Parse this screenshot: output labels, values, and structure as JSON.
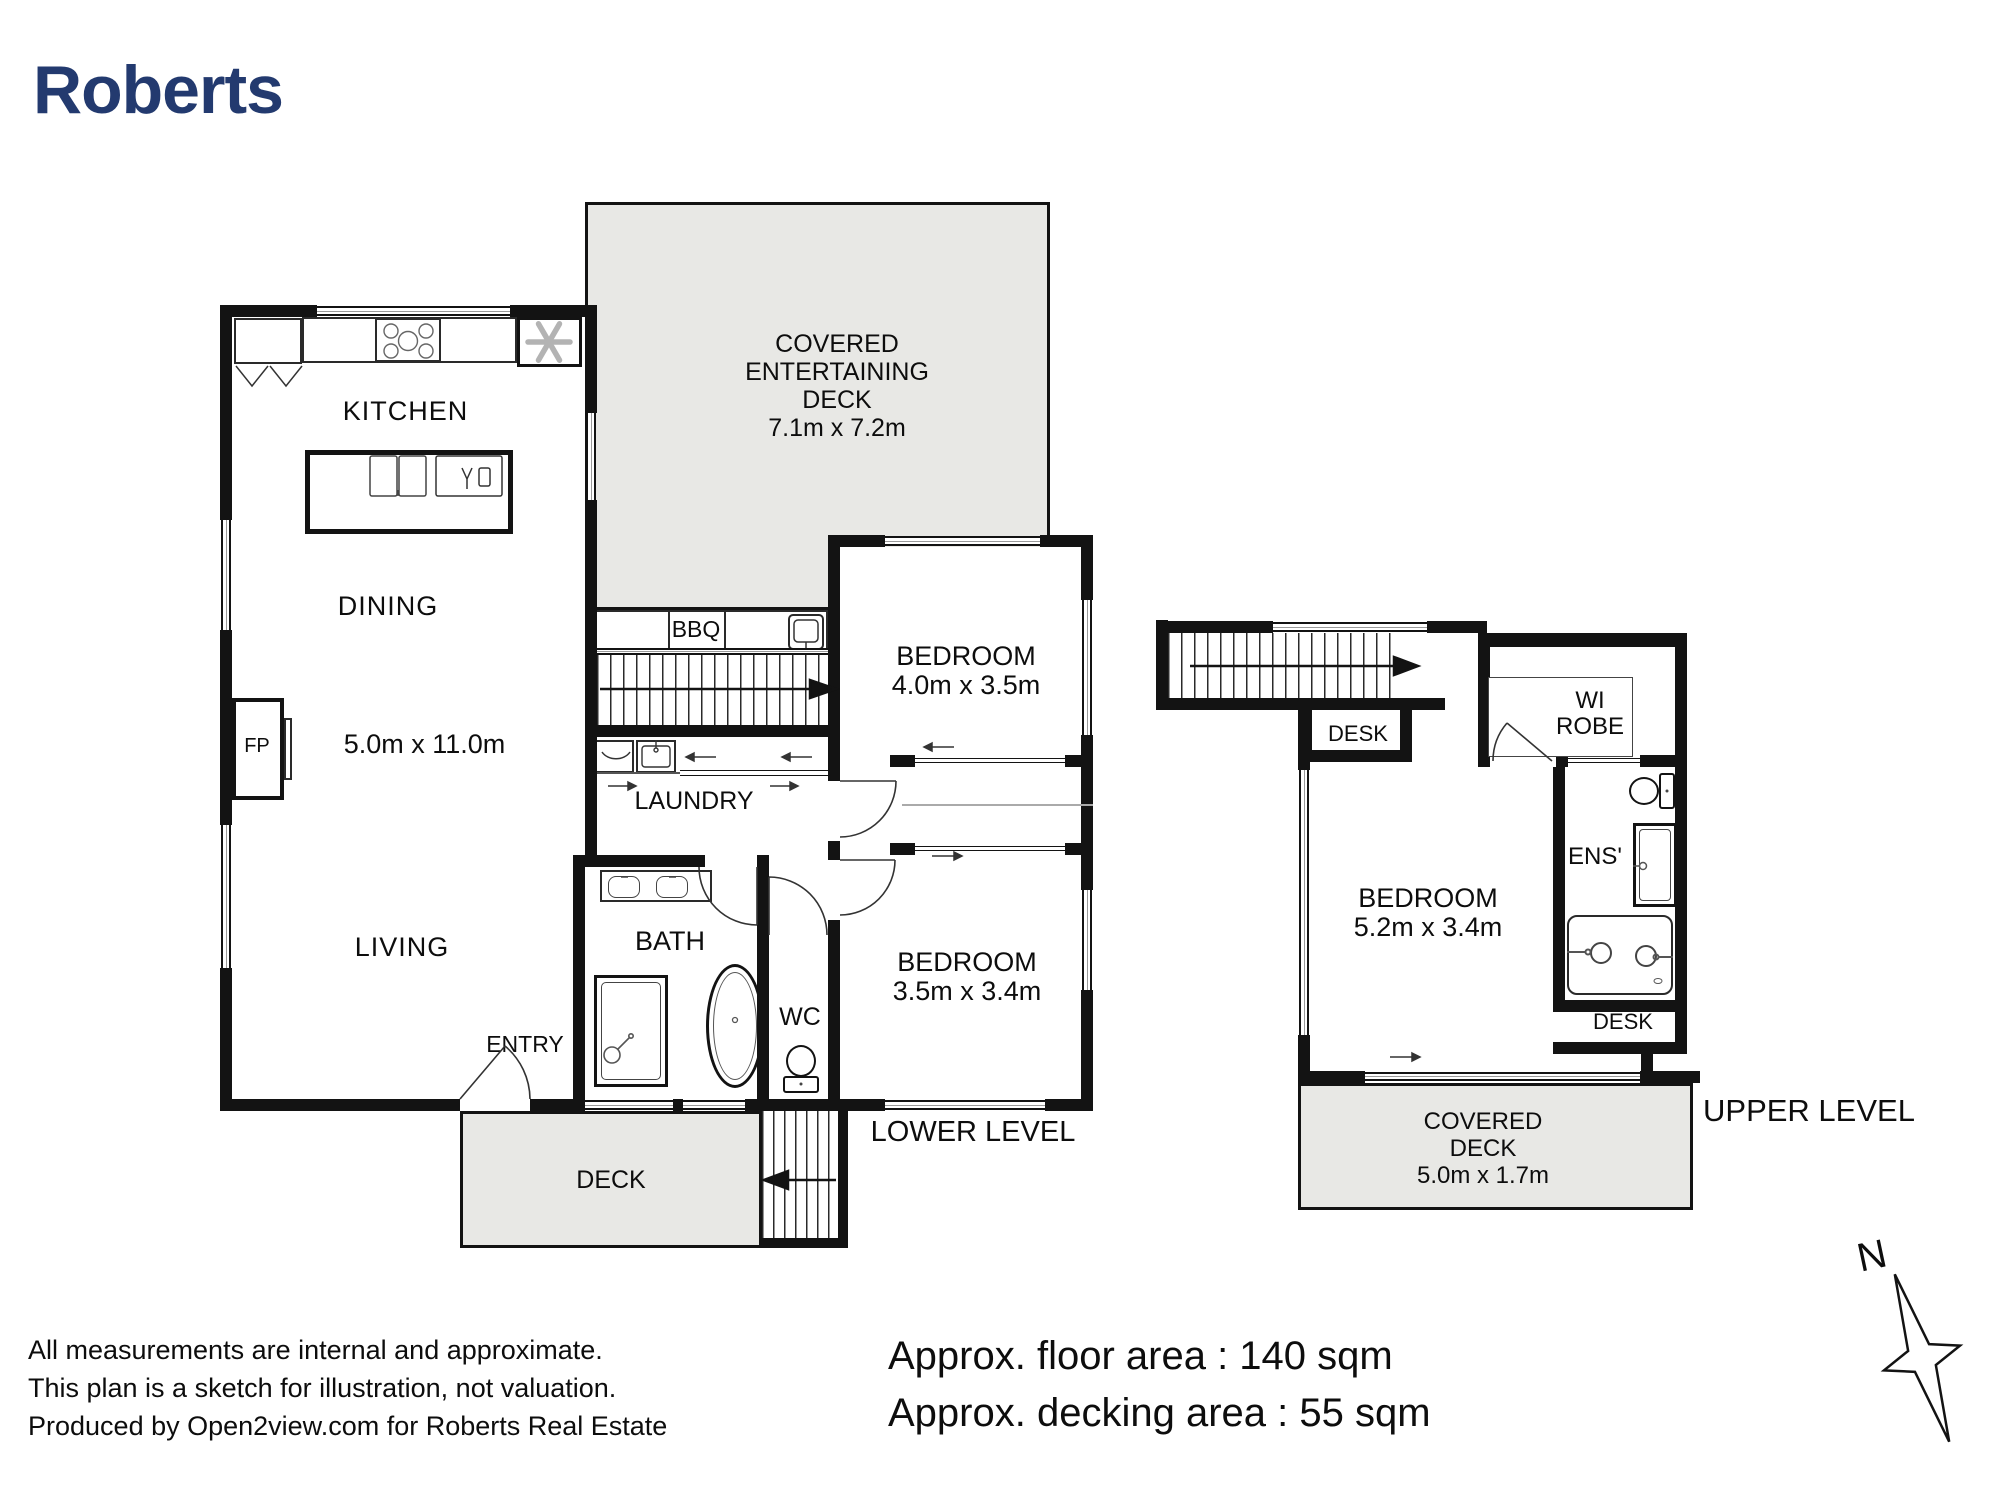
{
  "brand": {
    "logo": "Roberts",
    "color": "#233a6f"
  },
  "lower": {
    "title": "LOWER LEVEL",
    "covered_deck": {
      "l1": "COVERED",
      "l2": "ENTERTAINING",
      "l3": "DECK",
      "dims": "7.1m x 7.2m"
    },
    "kitchen": "KITCHEN",
    "dining": "DINING",
    "living_dims": "5.0m x 11.0m",
    "fireplace": "FP",
    "living": "LIVING",
    "entry": "ENTRY",
    "bbq": "BBQ",
    "laundry": "LAUNDRY",
    "bath": "BATH",
    "wc": "WC",
    "bedroom1": {
      "name": "BEDROOM",
      "dims": "4.0m x 3.5m"
    },
    "bedroom2": {
      "name": "BEDROOM",
      "dims": "3.5m x 3.4m"
    },
    "deck": "DECK"
  },
  "upper": {
    "title": "UPPER LEVEL",
    "desk1": "DESK",
    "desk2": "DESK",
    "wi_robe": {
      "l1": "WI",
      "l2": "ROBE"
    },
    "ensuite": "ENS'",
    "bedroom": {
      "name": "BEDROOM",
      "dims": "5.2m x 3.4m"
    },
    "covered_deck": {
      "l1": "COVERED",
      "l2": "DECK",
      "dims": "5.0m x 1.7m"
    }
  },
  "compass": {
    "north": "N"
  },
  "footer": {
    "disclaimer": [
      "All measurements are internal and approximate.",
      "This plan is a sketch for illustration, not valuation.",
      "Produced by Open2view.com for Roberts Real Estate"
    ],
    "floor_area": "Approx. floor area : 140 sqm",
    "decking_area": "Approx. decking area : 55 sqm"
  },
  "colors": {
    "wall": "#131313",
    "deck_fill": "#e8e8e5"
  }
}
